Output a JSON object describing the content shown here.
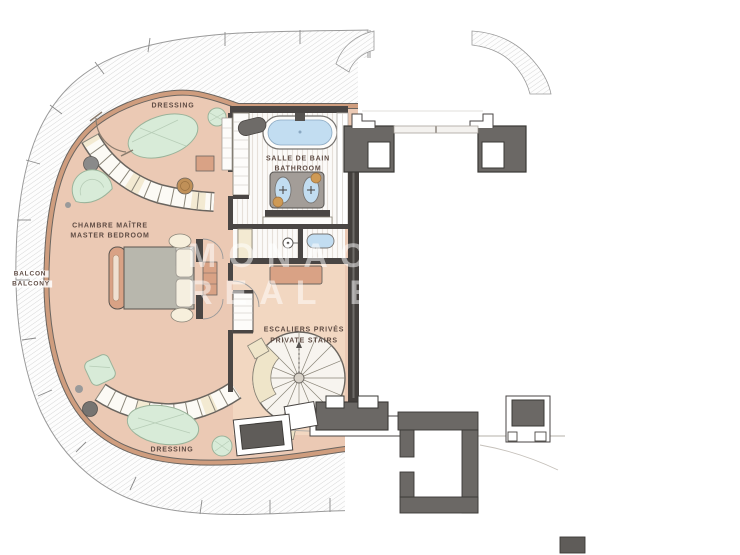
{
  "plan": {
    "labels": {
      "dressing_top": "DRESSING",
      "salle_de_bain": "SALLE DE BAIN",
      "bathroom": "BATHROOM",
      "chambre_maitre": "CHAMBRE MAÎTRE",
      "master_bedroom": "MASTER BEDROOM",
      "balcon": "BALCON",
      "balcony": "BALCONY",
      "escaliers_prives": "ESCALIERS PRIVÉS",
      "private_stairs": "PRIVATE STAIRS",
      "dressing_bottom": "DRESSING"
    },
    "watermark": {
      "line1": "MONACO",
      "line2": "REAL ESTATE"
    },
    "rooms": [
      {
        "fr": "DRESSING",
        "en": ""
      },
      {
        "fr": "SALLE DE BAIN",
        "en": "BATHROOM"
      },
      {
        "fr": "CHAMBRE MAÎTRE",
        "en": "MASTER BEDROOM"
      },
      {
        "fr": "BALCON",
        "en": "BALCONY"
      },
      {
        "fr": "ESCALIERS PRIVÉS",
        "en": "PRIVATE STAIRS"
      },
      {
        "fr": "DRESSING",
        "en": ""
      }
    ],
    "colors": {
      "floor": "#ebc9b4",
      "stair_hall_floor": "#f2d7c1",
      "wall_tan": "#cf9d7e",
      "wall_dark": "#4a4644",
      "rug_green": "#d8ebd8",
      "rug_green_line": "#9ab39a",
      "water_blue": "#c2ddf1",
      "wood_tan": "#d9a285",
      "counter_gray": "#a39d98",
      "label_text": "#5f4c44",
      "watermark": "rgba(255,255,255,0.5)"
    }
  }
}
